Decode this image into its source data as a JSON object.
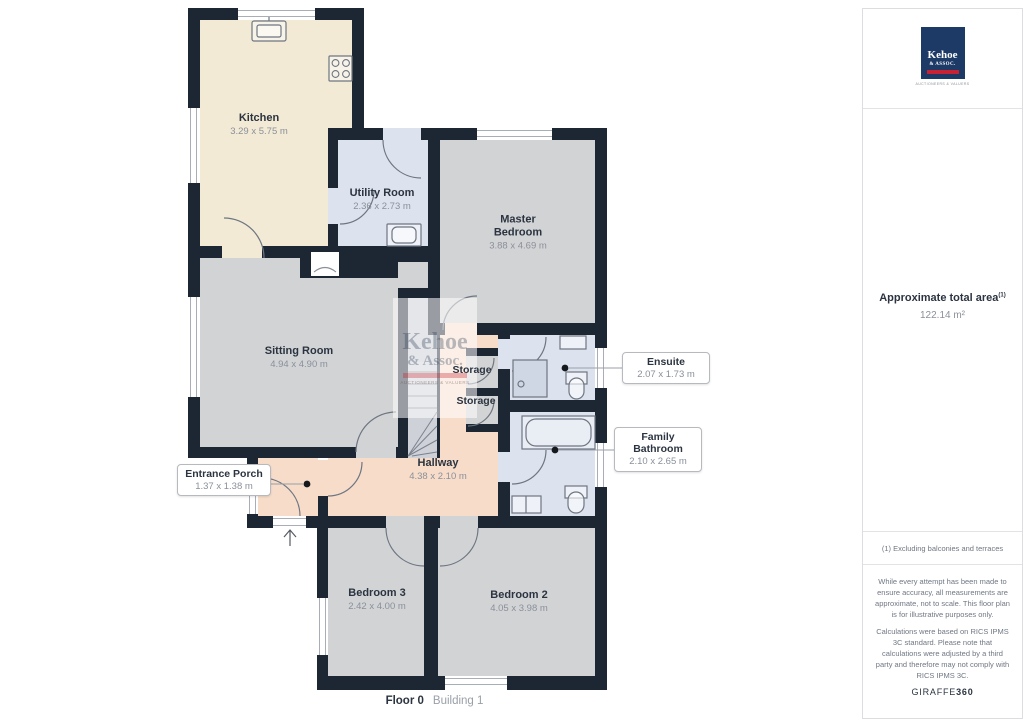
{
  "plan": {
    "rooms": [
      {
        "name": "Kitchen",
        "dims": "3.29 x 5.75 m"
      },
      {
        "name": "Utility Room",
        "dims": "2.36 x 2.73 m"
      },
      {
        "name": "Master Bedroom",
        "dims": "3.88 x 4.69 m"
      },
      {
        "name": "Sitting Room",
        "dims": "4.94 x 4.90 m"
      },
      {
        "name": "Hallway",
        "dims": "4.38 x 2.10 m"
      },
      {
        "name": "Bedroom 3",
        "dims": "2.42 x 4.00 m"
      },
      {
        "name": "Bedroom 2",
        "dims": "4.05 x 3.98 m"
      }
    ],
    "storage_labels": [
      "Storage",
      "Storage"
    ],
    "callouts": [
      {
        "name": "Entrance Porch",
        "dims": "1.37 x 1.38 m"
      },
      {
        "name": "Ensuite",
        "dims": "2.07 x 1.73 m"
      },
      {
        "name": "Family Bathroom",
        "dims": "2.10 x 2.65 m"
      }
    ],
    "caption": {
      "floor": "Floor 0",
      "building": "Building 1"
    }
  },
  "watermark": {
    "line1": "Kehoe",
    "line2": "& Assoc.",
    "line3": "AUCTIONEERS & VALUERS"
  },
  "sidebar": {
    "logo": {
      "line1": "Kehoe",
      "line2": "& ASSOC.",
      "tagline": "AUCTIONEERS & VALUERS"
    },
    "area": {
      "label": "Approximate total area",
      "sup": "(1)",
      "value": "122.14 m²"
    },
    "footnote": "(1) Excluding balconies and terraces",
    "disclaimer1": "While every attempt has been made to ensure accuracy, all measurements are approximate, not to scale. This floor plan is for illustrative purposes only.",
    "disclaimer2": "Calculations were based on RICS IPMS 3C standard. Please note that calculations were adjusted by a third party and therefore may not comply with RICS IPMS 3C.",
    "brand": {
      "name": "GIRAFFE",
      "suffix": "360"
    }
  },
  "colors": {
    "wall": "#1d2734",
    "kitchen": "#f2ead5",
    "bedroom_gray": "#d2d3d5",
    "wet_blue": "#dde3ee",
    "hall_salmon": "#f7dcc9",
    "logo_navy": "#1d3a66",
    "logo_red": "#c62233",
    "label_dark": "#2b3440",
    "label_gray": "#8a909a"
  }
}
